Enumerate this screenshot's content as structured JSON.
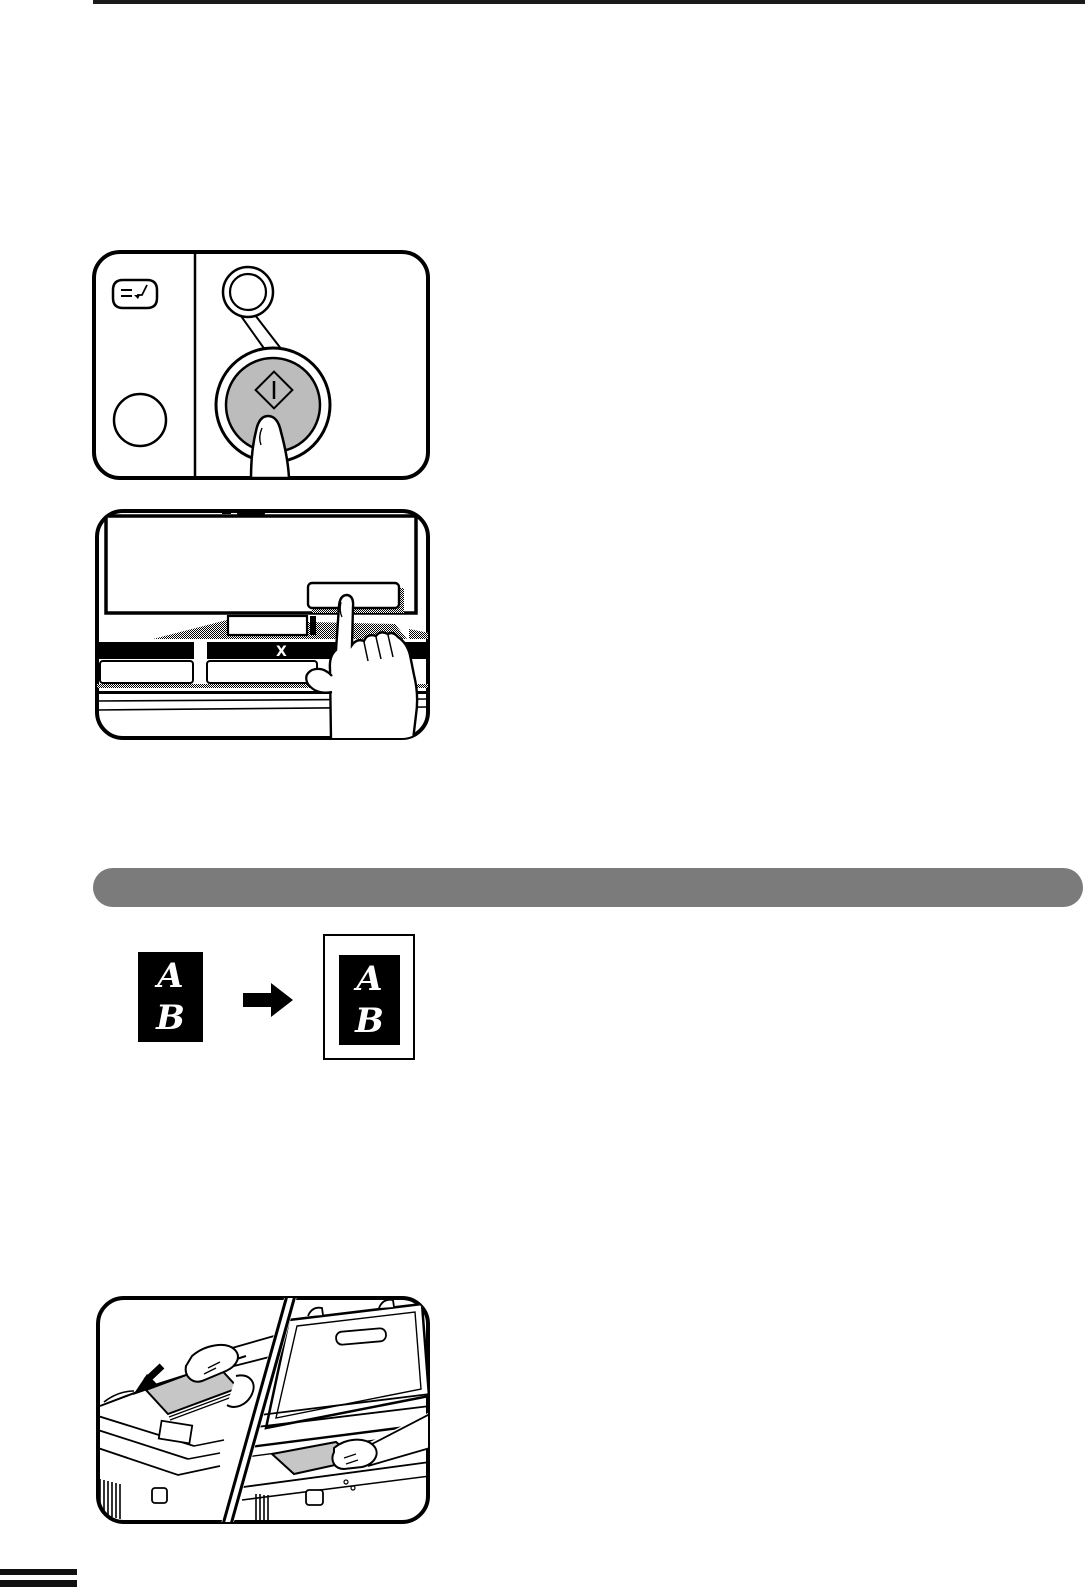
{
  "page": {
    "type": "copier-manual-page",
    "background": "#ffffff",
    "top_rule_color": "#1a1a1a",
    "edge_tab_color": "#111111"
  },
  "section_bar": {
    "color": "#7b7b7b",
    "label": ""
  },
  "figure_start_key": {
    "name": "press-start-key-illustration",
    "icons": [
      "interrupt-key-icon",
      "clear-key-icon",
      "start-key-indicator",
      "start-key-diamond-icon"
    ],
    "start_button_fill": "#bcbcbc"
  },
  "figure_touch_panel": {
    "name": "touch-panel-key-press-illustration",
    "zoom_label": "X",
    "display_fill": "#ffffff"
  },
  "figure_copy_example": {
    "name": "original-to-copy-illustration",
    "original": {
      "top_letter": "A",
      "bottom_letter": "B"
    },
    "copy": {
      "top_letter": "A",
      "bottom_letter": "B"
    },
    "arrow": "right-arrow-icon"
  },
  "figure_set_originals": {
    "name": "set-originals-illustration",
    "scenes": [
      "document-feeder-loading",
      "platen-glass-placing"
    ],
    "paper_fill": "#c6c6c6"
  }
}
